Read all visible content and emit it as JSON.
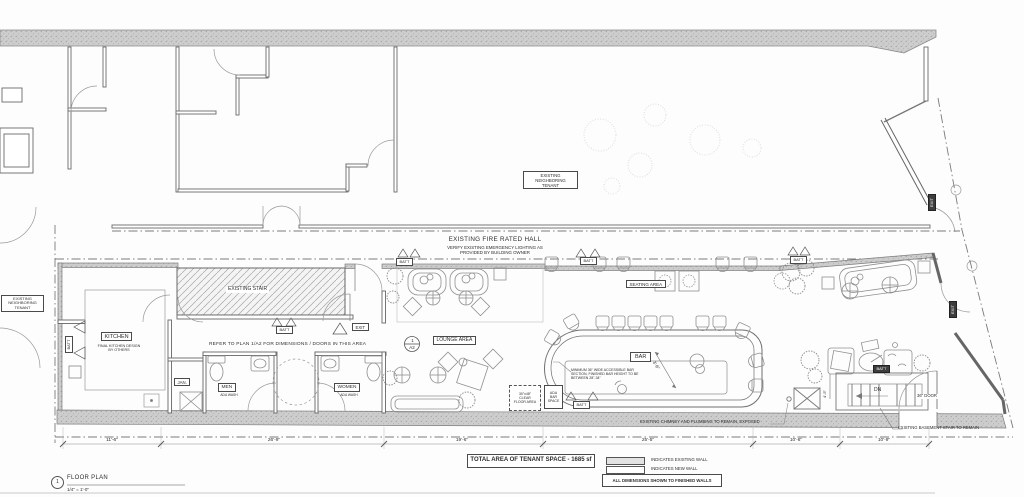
{
  "titleblock": {
    "number": "1",
    "title": "FLOOR PLAN",
    "scale": "1/4\" = 1'-0\""
  },
  "summary": {
    "total_area": "TOTAL AREA OF TENANT SPACE - 1685 sf"
  },
  "legend": {
    "existing": "INDICATES EXISTING WALL",
    "new": "INDICATES NEW WALL",
    "note": "ALL DIMENSIONS SHOWN TO FINISHED WALLS"
  },
  "labels": {
    "neighboring_tenant": "EXISTING\nNEIGHBORING\nTENANT",
    "fire_hall_title": "EXISTING FIRE RATED HALL",
    "fire_hall_note": "VERIFY EXISTING EMERGENCY LIGHTING AS\nPROVIDED BY BUILDING OWNER",
    "existing_stair": "EXISTING STAIR",
    "refer_note": "REFER TO PLAN 1/A2 FOR DIMENSIONS / DOORS IN THIS AREA",
    "kitchen": "KITCHEN",
    "kitchen_note": "FINAL KITCHEN DESIGN\nBY OTHERS",
    "jan": "JAN.",
    "men": "MEN",
    "women": "WOMEN",
    "ada_wash": "ADA WASH",
    "lounge_area": "LOUNGE AREA",
    "seating_area": "SEATING AREA",
    "bar": "BAR",
    "bar_note": "MINIMUM 36\" WIDE ACCESSIBLE BAR\nSECTION, FINISHED BAR HEIGHT TO BE\nBETWEEN 28\"-34\"",
    "clear_floor": "30\"x48\"\nCLEAR\nFLOOR AREA",
    "ada_bar_space": "ADA\nBAR\nSPACE",
    "batt": "BATT",
    "exit": "EXIT",
    "dn": "DN",
    "door_36": "36\" DOOR",
    "dim_bar": "3'-6\"",
    "dim_stair": "4'-5\"",
    "chimney_note": "EXISTING CHIMNEY AND PLUMBING TO REMAIN, EXPOSED",
    "basement_note": "EXISTING BASEMENT STAIR TO REMAIN",
    "callout": {
      "num": "1",
      "sheet": "A2"
    }
  },
  "dims": [
    "11'-6\"",
    "26'-9\"",
    "19'-6\"",
    "25'-5\"",
    "10'-6\"",
    "10'-9\""
  ],
  "colors": {
    "line": "#5a5a5a",
    "wall_fill": "#cccccc",
    "paper": "#fdfdfd"
  }
}
